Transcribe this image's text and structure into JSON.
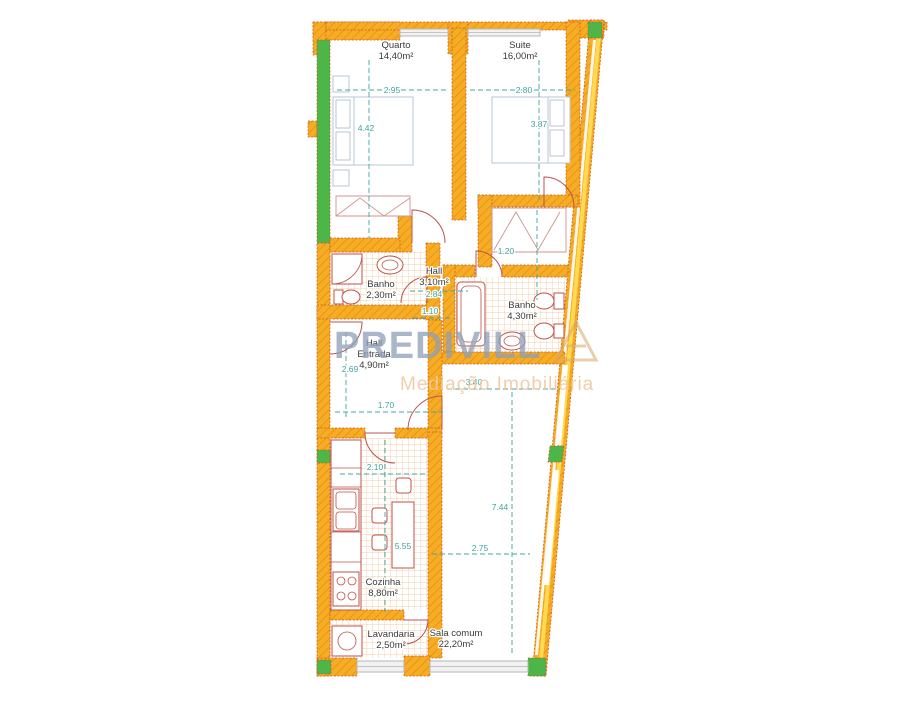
{
  "plan": {
    "watermark": {
      "brand": "PREDIVILL",
      "tagline": "Mediação Imobiliária"
    },
    "rooms": [
      {
        "id": "quarto",
        "label": "Quarto",
        "area": "14,40m²"
      },
      {
        "id": "suite",
        "label": "Suite",
        "area": "16,00m²"
      },
      {
        "id": "banho-small",
        "label": "Banho",
        "area": "2,30m²"
      },
      {
        "id": "hall",
        "label": "Hall",
        "area": "3,10m²"
      },
      {
        "id": "banho-suite",
        "label": "Banho",
        "area": "4,30m²"
      },
      {
        "id": "hall-entrada",
        "label": "Hall",
        "label2": "Entrada",
        "area": "4,90m²"
      },
      {
        "id": "cozinha",
        "label": "Cozinha",
        "area": "8,80m²"
      },
      {
        "id": "lavandaria",
        "label": "Lavandaria",
        "area": "2,50m²"
      },
      {
        "id": "sala-comum",
        "label": "Sala comum",
        "area": "22,20m²"
      }
    ],
    "dimensions": {
      "quarto_width": "2.95",
      "quarto_depth": "4.42",
      "suite_width": "2.80",
      "suite_depth": "3.87",
      "closet_width": "1.20",
      "hall_width": "2.84",
      "hall_opening": "1.10",
      "entrada_depth": "2.69",
      "entrada_width": "1.70",
      "cozinha_width": "2.10",
      "cozinha_depth": "5.55",
      "sala_width": "2.75",
      "sala_width_top": "3.40",
      "sala_depth": "7.44"
    },
    "colors": {
      "wall_orange": "#F7AC26",
      "wall_hatch": "#E2920E",
      "wall_outline": "#C8551F",
      "window_green": "#4CB748",
      "dimension_teal": "#3FA5A0",
      "fixture_red": "#C05046",
      "bed_gray": "#B9C6D6",
      "tile_orange": "#F0C08C",
      "window_gray": "#B5B5B5",
      "watermark_blue": "#8D9FB8",
      "watermark_tan": "#EFC9A2"
    }
  }
}
